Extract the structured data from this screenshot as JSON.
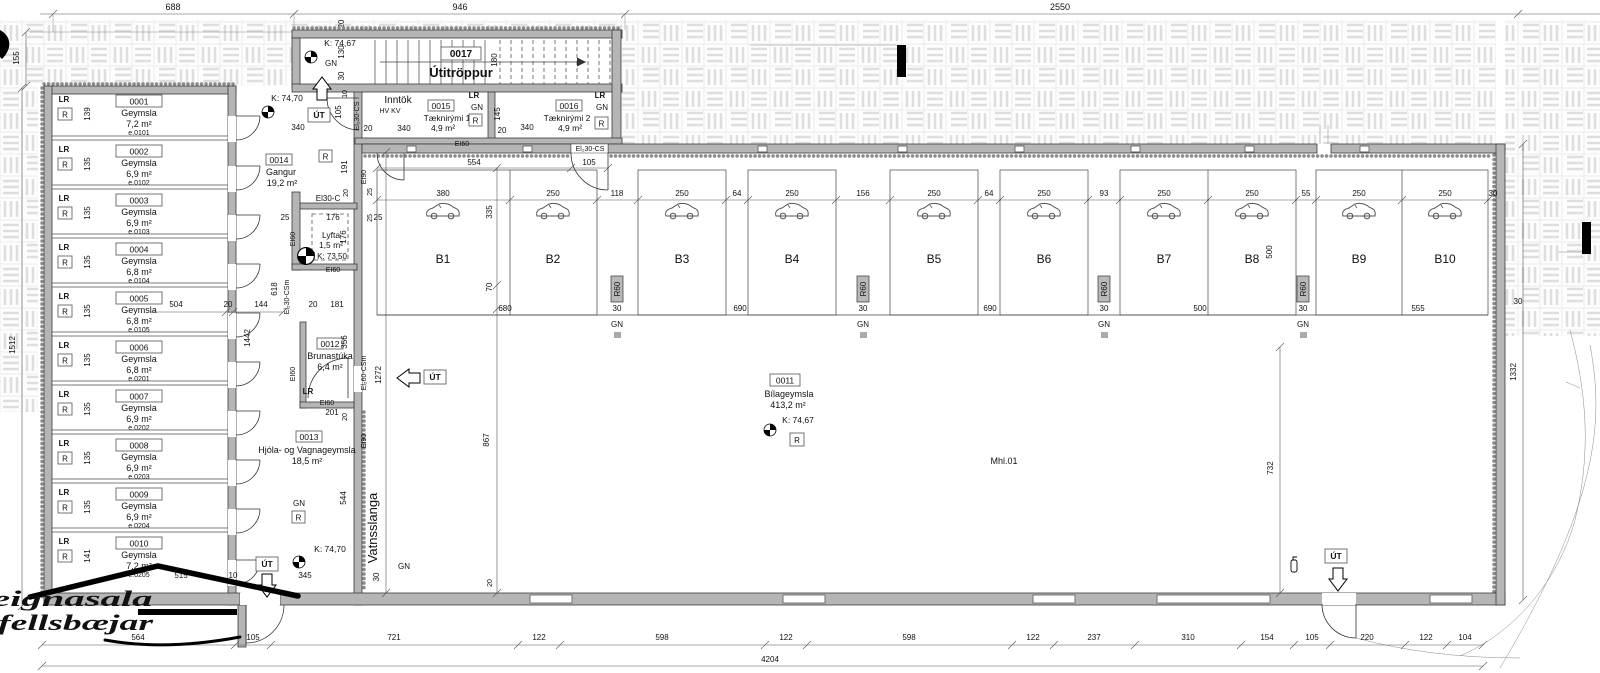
{
  "logo": {
    "line1": "Fasteignasala",
    "line2": "Mosfellsbæjar"
  },
  "t": {
    "geymsla": "Geymsla",
    "lr": "LR",
    "r": "R",
    "gn": "GN",
    "ut": "ÚT",
    "r60": "R60",
    "ei60": "EI60",
    "ei90": "EI90",
    "ei30c": "El30-C",
    "el230cs": "El₂30-CS",
    "el230csm": "El₂30-CSm",
    "el260csm": "El₂60-CSm",
    "hvkv": "HV KV",
    "k7467": "K: 74,67",
    "k7470": "K: 74,70",
    "k7350": "K: 73,50",
    "mhl": "Mhl.01",
    "vatn": "Vatnsslanga",
    "d10": "10",
    "d20": "20",
    "d25": "25",
    "d30": "30",
    "d55": "55",
    "d64": "64",
    "d70": "70",
    "d93": "93",
    "d104": "104",
    "d105": "105",
    "d118": "118",
    "d122": "122",
    "d130": "130",
    "d144": "144",
    "d145": "145",
    "d154": "154",
    "d155": "155",
    "d156": "156",
    "d176": "176",
    "d180": "180",
    "d181": "181",
    "d191": "191",
    "d201": "201",
    "d220": "220",
    "d237": "237",
    "d250": "250",
    "d310": "310",
    "d335": "335",
    "d340": "340",
    "d345": "345",
    "d356": "356",
    "d380": "380",
    "d500": "500",
    "d504": "504",
    "d515": "515",
    "d544": "544",
    "d554": "554",
    "d555": "555",
    "d564": "564",
    "d598": "598",
    "d618": "618",
    "d680": "680",
    "d688": "688",
    "d690": "690",
    "d721": "721",
    "d732": "732",
    "d867": "867",
    "d946": "946",
    "d1272": "1272",
    "d1332": "1332",
    "d1442": "1442",
    "d1512": "1512",
    "d2550": "2550",
    "d4204": "4204"
  },
  "rooms": {
    "storage": [
      {
        "id": "0001",
        "area": "7,2 m²",
        "code": "e.0101",
        "h": "139"
      },
      {
        "id": "0002",
        "area": "6,9 m²",
        "code": "e.0102",
        "h": "135"
      },
      {
        "id": "0003",
        "area": "6,9 m²",
        "code": "e.0103",
        "h": "135"
      },
      {
        "id": "0004",
        "area": "6,8 m²",
        "code": "e.0104",
        "h": "135"
      },
      {
        "id": "0005",
        "area": "6,8 m²",
        "code": "e.0105",
        "h": "135"
      },
      {
        "id": "0006",
        "area": "6,8 m²",
        "code": "e.0201",
        "h": "135"
      },
      {
        "id": "0007",
        "area": "6,9 m²",
        "code": "e.0202",
        "h": "135"
      },
      {
        "id": "0008",
        "area": "6,9 m²",
        "code": "e.0203",
        "h": "135"
      },
      {
        "id": "0009",
        "area": "6,9 m²",
        "code": "e.0204",
        "h": "135"
      },
      {
        "id": "0010",
        "area": "7,2 m²",
        "code": "e.0205",
        "h": "141"
      }
    ],
    "gangur": {
      "id": "0014",
      "name": "Gangur",
      "area": "19,2 m²"
    },
    "lyfta": {
      "name": "Lyfta",
      "area": "1,5 m²",
      "level": "K: 73,50"
    },
    "brunastuka": {
      "id": "0012",
      "name": "Brunastúka",
      "area": "6,4 m²"
    },
    "hjola": {
      "id": "0013",
      "name": "Hjóla- og Vagnageymsla",
      "area": "18,5 m²"
    },
    "inntok": {
      "name": "Inntök",
      "sub": "HV KV"
    },
    "taekni1": {
      "id": "0015",
      "name": "Tæknirými 1",
      "area": "4,9 m²"
    },
    "taekni2": {
      "id": "0016",
      "name": "Tæknirými 2",
      "area": "4,9 m²"
    },
    "stairs": {
      "id": "0017",
      "name": "Útitröppur"
    },
    "garage": {
      "id": "0011",
      "name": "Bílageymsla",
      "area": "413,2 m²",
      "level": "K: 74,67",
      "unit": "Mhl.01"
    }
  },
  "stalls": [
    "B1",
    "B2",
    "B3",
    "B4",
    "B5",
    "B6",
    "B7",
    "B8",
    "B9",
    "B10"
  ]
}
